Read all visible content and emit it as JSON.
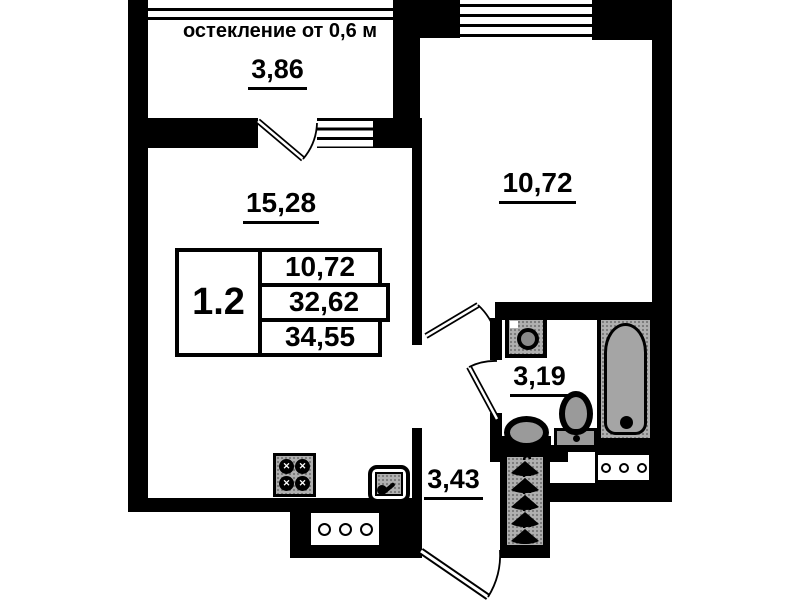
{
  "annotations": {
    "glazing_note": "остекление от 0,6 м"
  },
  "rooms": {
    "balcony": {
      "area": "3,86"
    },
    "living_room": {
      "area": "15,28"
    },
    "bedroom": {
      "area": "10,72"
    },
    "bathroom": {
      "area": "3,19"
    },
    "hallway": {
      "area": "3,43"
    }
  },
  "legend": {
    "apartment_type": "1.2",
    "values": [
      "10,72",
      "32,62",
      "34,55"
    ]
  },
  "icons": [
    "stove-icon",
    "kitchen-sink-icon",
    "washing-machine-icon",
    "bathtub-icon",
    "toilet-icon",
    "bathroom-sink-icon",
    "coat-hanger-icon",
    "vent-grille-icon",
    "door-swing-icon",
    "window-icon"
  ],
  "colors": {
    "wall": "#000000",
    "fixture_fill": "#b0b0b0",
    "background": "#ffffff"
  }
}
